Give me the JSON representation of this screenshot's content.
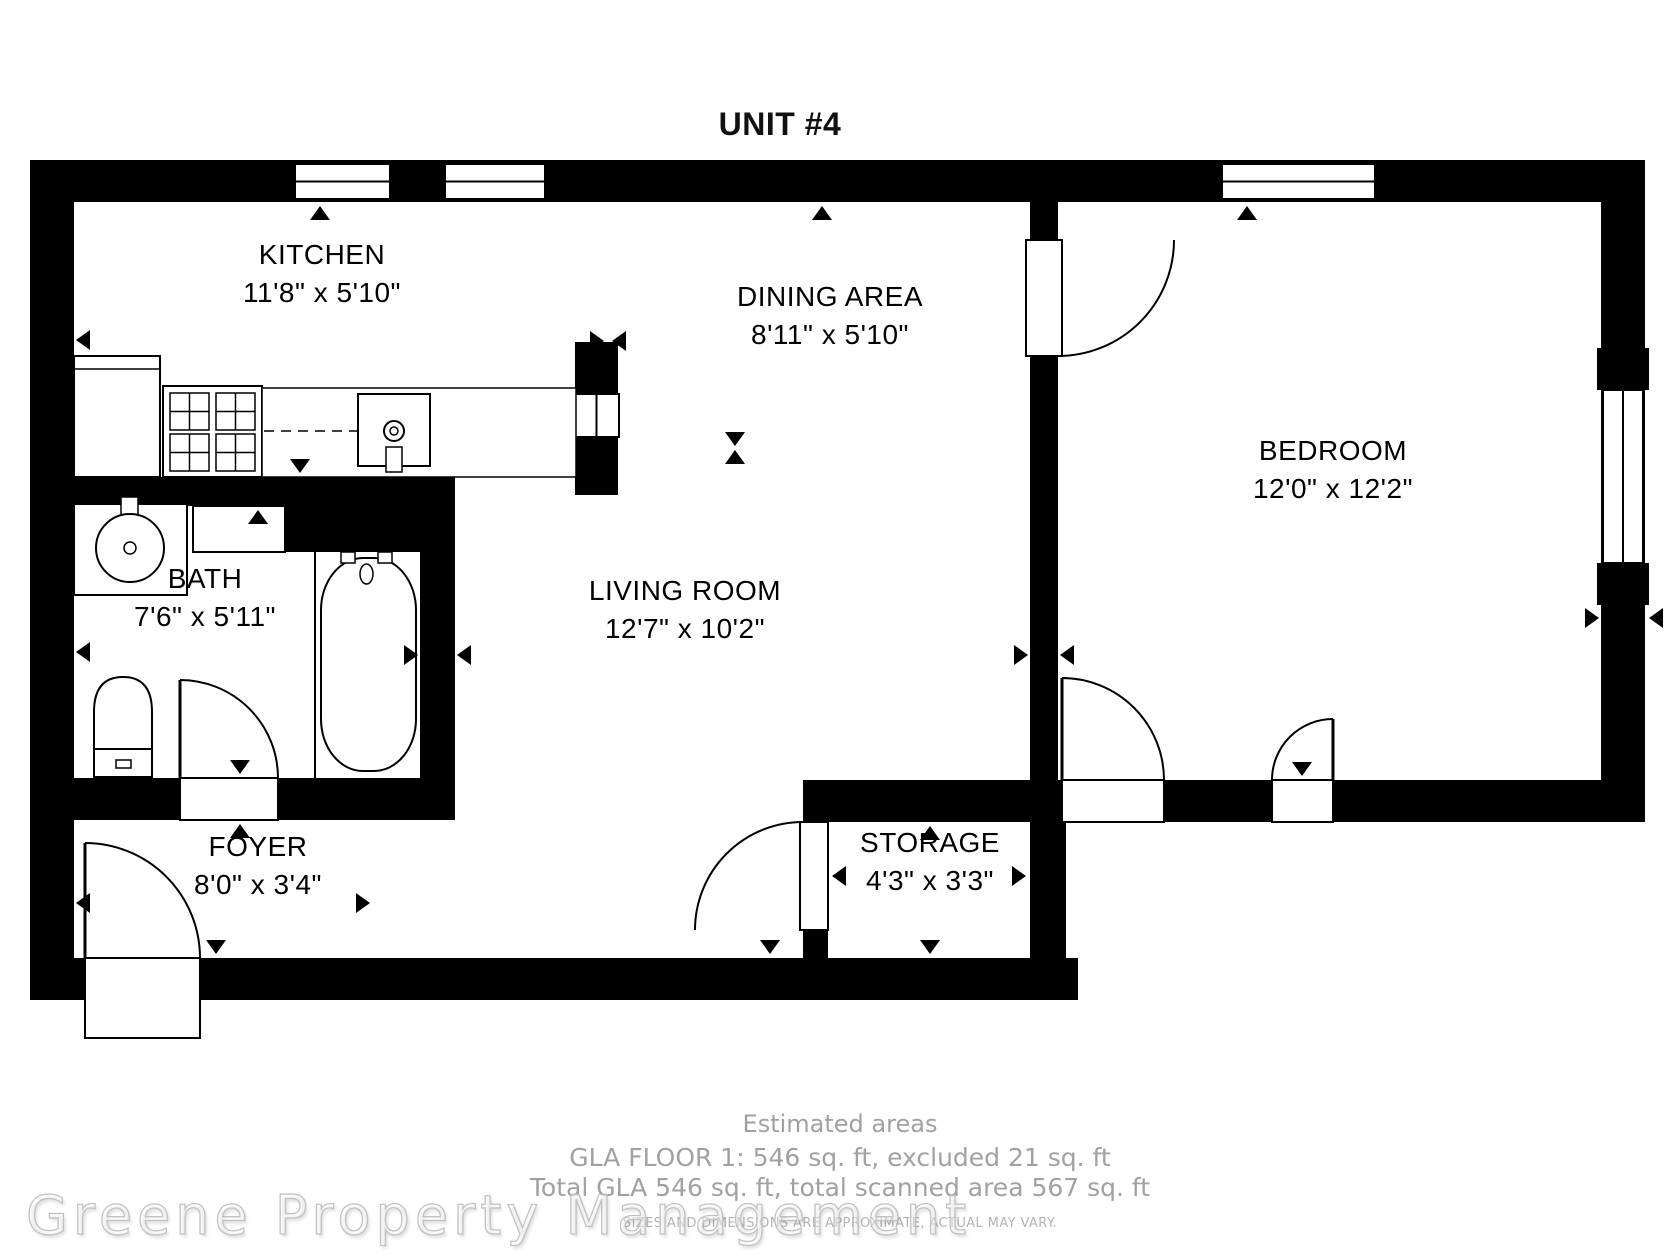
{
  "title": "UNIT #4",
  "rooms": [
    {
      "name": "KITCHEN",
      "dims": "11'8\" x 5'10\""
    },
    {
      "name": "DINING AREA",
      "dims": "8'11\" x 5'10\""
    },
    {
      "name": "BEDROOM",
      "dims": "12'0\" x 12'2\""
    },
    {
      "name": "BATH",
      "dims": "7'6\" x 5'11\""
    },
    {
      "name": "LIVING ROOM",
      "dims": "12'7\" x 10'2\""
    },
    {
      "name": "FOYER",
      "dims": "8'0\" x 3'4\""
    },
    {
      "name": "STORAGE",
      "dims": "4'3\" x 3'3\""
    }
  ],
  "footer": {
    "estimated_areas_label": "Estimated areas",
    "gla_line1": "GLA FLOOR 1: 546 sq. ft, excluded 21 sq. ft",
    "gla_line2": "Total GLA 546 sq. ft, total scanned area 567 sq. ft",
    "disclaimer": "SIZES AND DIMENSIONS ARE APPROXIMATE, ACTUAL MAY VARY.",
    "watermark": "Greene Property Management"
  },
  "colors": {
    "wall": "#000000",
    "floor": "#ffffff",
    "label_text": "#000000",
    "footer_text": "#a1a1a1",
    "disclaimer_text": "#b4b4b4",
    "watermark_outline": "#c2c2c2"
  }
}
